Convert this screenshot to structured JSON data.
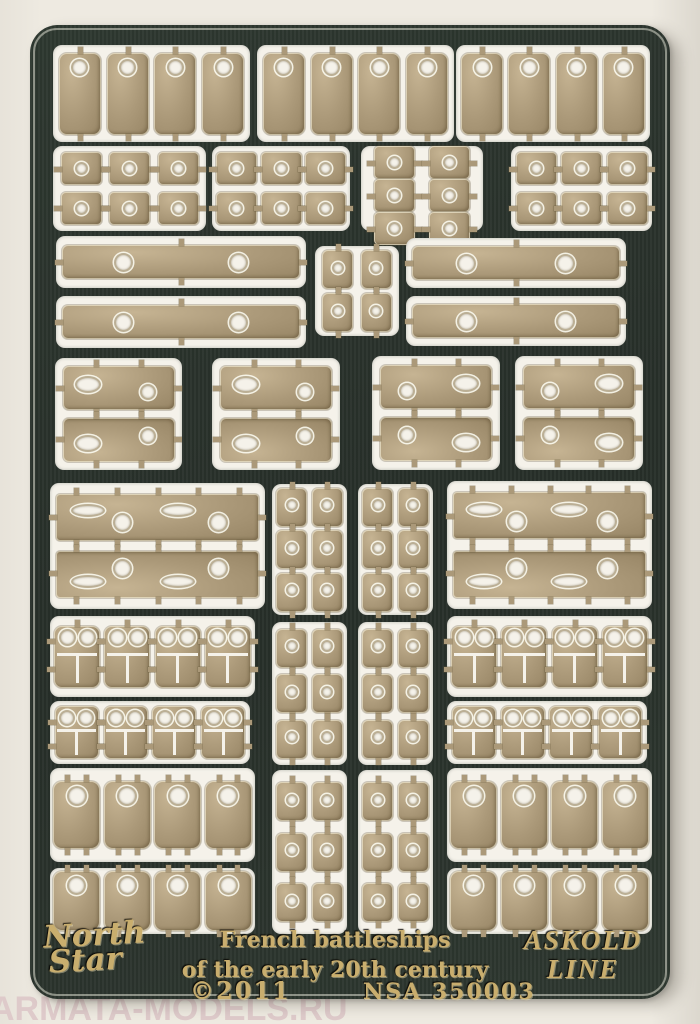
{
  "labels": {
    "brand_line1": "North",
    "brand_line2": "Star",
    "title_line1": "French battleships",
    "title_line2": "of the early 20th century",
    "copyright": "©2011",
    "catalog_number": "NSA 350003",
    "maker_line1": "ASKOLD",
    "maker_line2": "LINE",
    "watermark": "ARMATA-MODELS.RU"
  },
  "colors": {
    "background": "#eeeae1",
    "sheet_green": "#2e3830",
    "sheet_green_dark": "#272f29",
    "window_white": "#f5f2ea",
    "brass": "#ab9979",
    "brass_light": "#c6b493",
    "brass_dark": "#8e7c5c",
    "etched_gold": "#c9ae6e",
    "watermark": "#decaca"
  },
  "sheet": {
    "windows": [
      {
        "name": "large-doors-left",
        "x": 23,
        "y": 20,
        "w": 197,
        "h": 97,
        "type": "door-tall",
        "rows": 1,
        "cols": 4
      },
      {
        "name": "large-doors-center",
        "x": 227,
        "y": 20,
        "w": 197,
        "h": 97,
        "type": "door-tall",
        "rows": 1,
        "cols": 4
      },
      {
        "name": "large-doors-right",
        "x": 426,
        "y": 20,
        "w": 194,
        "h": 97,
        "type": "door-tall",
        "rows": 1,
        "cols": 4
      },
      {
        "name": "small-plates-a",
        "x": 23,
        "y": 121,
        "w": 153,
        "h": 85,
        "type": "small-sq",
        "rows": 2,
        "cols": 3
      },
      {
        "name": "small-plates-b",
        "x": 182,
        "y": 121,
        "w": 138,
        "h": 85,
        "type": "small-sq",
        "rows": 2,
        "cols": 3
      },
      {
        "name": "small-plates-c",
        "x": 331,
        "y": 121,
        "w": 122,
        "h": 85,
        "type": "small-sq",
        "rows": 2,
        "cols": 3
      },
      {
        "name": "small-plates-d",
        "x": 481,
        "y": 121,
        "w": 141,
        "h": 85,
        "type": "small-sq",
        "rows": 2,
        "cols": 3
      },
      {
        "name": "long-strip-left-1",
        "x": 26,
        "y": 211,
        "w": 250,
        "h": 52,
        "type": "bar2",
        "rows": 1,
        "cols": 1
      },
      {
        "name": "long-strip-left-2",
        "x": 26,
        "y": 271,
        "w": 250,
        "h": 52,
        "type": "bar2",
        "rows": 1,
        "cols": 1
      },
      {
        "name": "hinge-plates-center",
        "x": 285,
        "y": 221,
        "w": 84,
        "h": 90,
        "type": "tiny-sq",
        "rows": 2,
        "cols": 2
      },
      {
        "name": "long-strip-right-1",
        "x": 376,
        "y": 213,
        "w": 220,
        "h": 50,
        "type": "bar2",
        "rows": 1,
        "cols": 1
      },
      {
        "name": "long-strip-right-2",
        "x": 376,
        "y": 271,
        "w": 220,
        "h": 50,
        "type": "bar2",
        "rows": 1,
        "cols": 1
      },
      {
        "name": "hatch-pair-a",
        "x": 25,
        "y": 333,
        "w": 127,
        "h": 112,
        "type": "wide-rect",
        "rows": 2,
        "cols": 1
      },
      {
        "name": "hatch-pair-b",
        "x": 182,
        "y": 333,
        "w": 128,
        "h": 112,
        "type": "wide-rect",
        "rows": 2,
        "cols": 1
      },
      {
        "name": "hatch-pair-c",
        "x": 342,
        "y": 331,
        "w": 128,
        "h": 114,
        "type": "wide-rect-m",
        "rows": 2,
        "cols": 1
      },
      {
        "name": "hatch-pair-d",
        "x": 485,
        "y": 331,
        "w": 128,
        "h": 114,
        "type": "wide-rect-m",
        "rows": 2,
        "cols": 1
      },
      {
        "name": "davit-strips-left",
        "x": 20,
        "y": 458,
        "w": 215,
        "h": 126,
        "type": "lens-bar",
        "rows": 2,
        "cols": 1
      },
      {
        "name": "rivet-plates-a",
        "x": 242,
        "y": 459,
        "w": 75,
        "h": 131,
        "type": "tiny-sq",
        "rows": 3,
        "cols": 2
      },
      {
        "name": "rivet-plates-b",
        "x": 328,
        "y": 459,
        "w": 75,
        "h": 131,
        "type": "tiny-sq",
        "rows": 3,
        "cols": 2
      },
      {
        "name": "davit-strips-right",
        "x": 417,
        "y": 456,
        "w": 205,
        "h": 128,
        "type": "lens-bar",
        "rows": 2,
        "cols": 1
      },
      {
        "name": "double-doors-left-1",
        "x": 20,
        "y": 591,
        "w": 205,
        "h": 81,
        "type": "owl",
        "rows": 1,
        "cols": 4
      },
      {
        "name": "rivet-plates-c",
        "x": 242,
        "y": 597,
        "w": 75,
        "h": 143,
        "type": "tiny-sq",
        "rows": 3,
        "cols": 2
      },
      {
        "name": "rivet-plates-d",
        "x": 328,
        "y": 597,
        "w": 75,
        "h": 143,
        "type": "tiny-sq",
        "rows": 3,
        "cols": 2
      },
      {
        "name": "double-doors-right-1",
        "x": 417,
        "y": 591,
        "w": 205,
        "h": 81,
        "type": "owl",
        "rows": 1,
        "cols": 4
      },
      {
        "name": "double-doors-left-2",
        "x": 20,
        "y": 676,
        "w": 200,
        "h": 63,
        "type": "owl-s",
        "rows": 1,
        "cols": 4
      },
      {
        "name": "double-doors-right-2",
        "x": 417,
        "y": 676,
        "w": 200,
        "h": 63,
        "type": "owl-s",
        "rows": 1,
        "cols": 4
      },
      {
        "name": "medium-doors-left-1",
        "x": 20,
        "y": 743,
        "w": 205,
        "h": 94,
        "type": "door-med",
        "rows": 1,
        "cols": 4
      },
      {
        "name": "rivet-plates-e",
        "x": 242,
        "y": 745,
        "w": 75,
        "h": 164,
        "type": "tiny-sq",
        "rows": 3,
        "cols": 2
      },
      {
        "name": "rivet-plates-f",
        "x": 328,
        "y": 745,
        "w": 75,
        "h": 164,
        "type": "tiny-sq",
        "rows": 3,
        "cols": 2
      },
      {
        "name": "medium-doors-right-1",
        "x": 417,
        "y": 743,
        "w": 205,
        "h": 94,
        "type": "door-med",
        "rows": 1,
        "cols": 4
      },
      {
        "name": "medium-doors-left-2",
        "x": 20,
        "y": 843,
        "w": 205,
        "h": 66,
        "type": "door-med2",
        "rows": 1,
        "cols": 4
      },
      {
        "name": "medium-doors-right-2",
        "x": 417,
        "y": 843,
        "w": 205,
        "h": 66,
        "type": "door-med2",
        "rows": 1,
        "cols": 4
      }
    ]
  }
}
